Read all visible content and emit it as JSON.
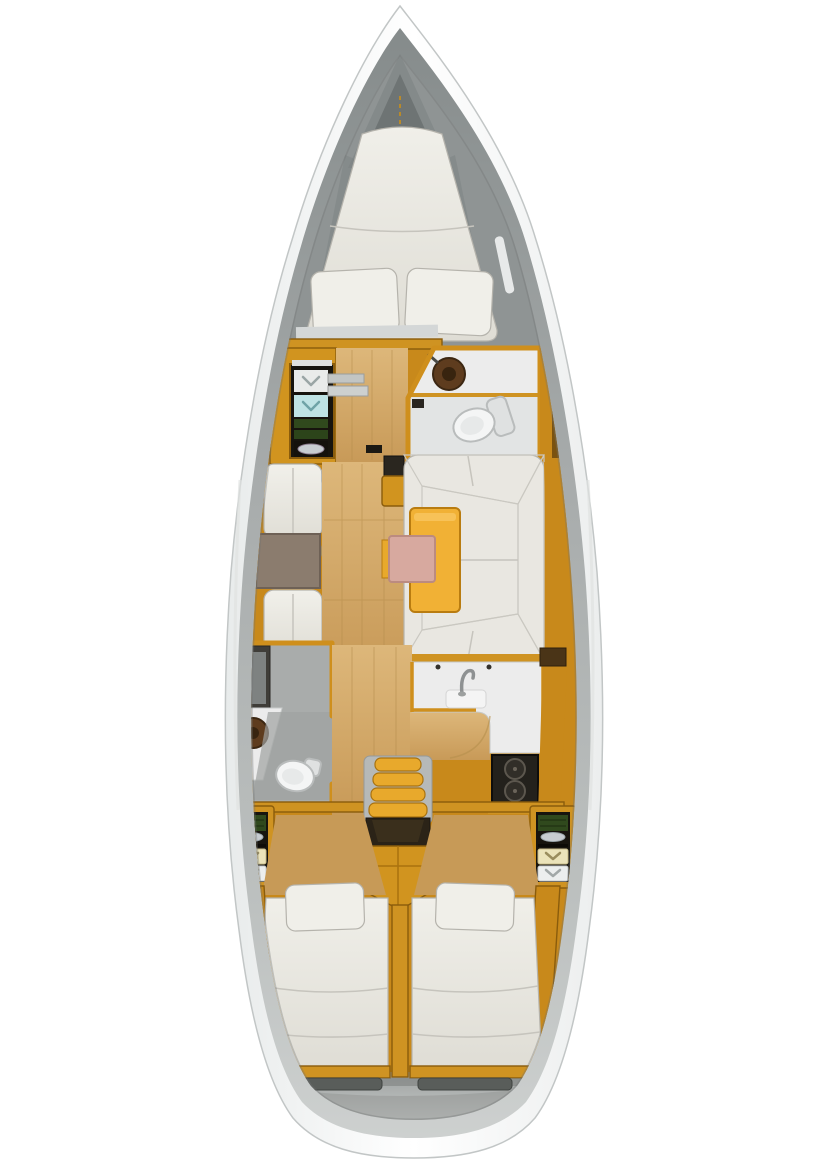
{
  "meta": {
    "title": "Sailboat interior layout — top-down floor plan",
    "orientation": "bow-up",
    "canvas": {
      "width": 828,
      "height": 1173
    }
  },
  "palette": {
    "hull_white": "#fbfcfc",
    "hull_stroke": "#c2c6c6",
    "deck_gray": "#a7abab",
    "bow_gray": "#8f9494",
    "anchor_gray": "#848a8a",
    "anchor_dark": "#6e7474",
    "wood": "#d1941f",
    "wood_bright": "#e8a92c",
    "wood_mid": "#cf9322",
    "wood_band": "#c8891b",
    "wood_dark_slab": "#4a3417",
    "engine_wood": "#d1941f",
    "floor_tan": "#d9b272",
    "floor_tan_aft": "#c79a57",
    "mattress_white": "#eae8e2",
    "cushion_white": "#e9e7e1",
    "cushion_light": "#f2f1ec",
    "pillow_white": "#f0efe9",
    "liner_gray": "#d4d7d7",
    "table_yellow": "#f1b135",
    "table_leaf_pink": "#d7a99f",
    "chart_table_brown": "#8b7c6e",
    "head_floor": "#e2e4e4",
    "head_floor_dark": "#9fa2a1",
    "counter_white": "#ececec",
    "toilet_white": "#f4f5f5",
    "sink_brown": "#5e3c1e",
    "sink_brown_dark": "#38240f",
    "shower_dark": "#3f3d38",
    "shower_floor": "#7e8281",
    "stove_black": "#23211c",
    "burner_gray": "#312e28",
    "landing_dark": "#2b2317",
    "mast_dark": "#2a261f",
    "threshold_dark": "#1c1913",
    "cabinet_dark": "#17140e",
    "shelf_white": "#e9ebea",
    "shelf_teal": "#bfe3e4",
    "shelf_green": "#30491d",
    "shelf_green_dark": "#2c441a",
    "shelf_cream": "#ebe3ba",
    "metal_silver": "#c7ccd0",
    "step_gray": "#c2c5c4",
    "rail_gray": "#b6b9b8",
    "bracket_gray": "#b7bab9",
    "wedge_gray": "#b0b3b2",
    "stern_locker": "#595d5a",
    "stern_fin": "#8d9190",
    "faucet_gray": "#8e9192"
  },
  "boat": {
    "sections": [
      {
        "id": "anchor-locker",
        "label": "Anchor locker (bow)"
      },
      {
        "id": "v-berth",
        "label": "Forward V-berth double bed with two pillows"
      },
      {
        "id": "wardrobe",
        "label": "Port wardrobe / shelf unit"
      },
      {
        "id": "forward-head",
        "label": "Forward head: round sink and toilet"
      },
      {
        "id": "salon-port",
        "label": "Port facing settees with table"
      },
      {
        "id": "dinette",
        "label": "Starboard U-shaped dinette with folding table"
      },
      {
        "id": "aft-head",
        "label": "Port aft head: shower, sink, toilet"
      },
      {
        "id": "galley",
        "label": "Starboard L-shaped galley: sink, faucet, two-burner stove"
      },
      {
        "id": "companionway",
        "label": "Companionway steps over engine compartment"
      },
      {
        "id": "aft-lockers",
        "label": "Port and starboard aft shelf lockers"
      },
      {
        "id": "aft-cabin-port",
        "label": "Port aft double cabin"
      },
      {
        "id": "aft-cabin-starboard",
        "label": "Starboard aft double cabin"
      },
      {
        "id": "stern",
        "label": "Stern deck with transom lockers"
      }
    ]
  }
}
